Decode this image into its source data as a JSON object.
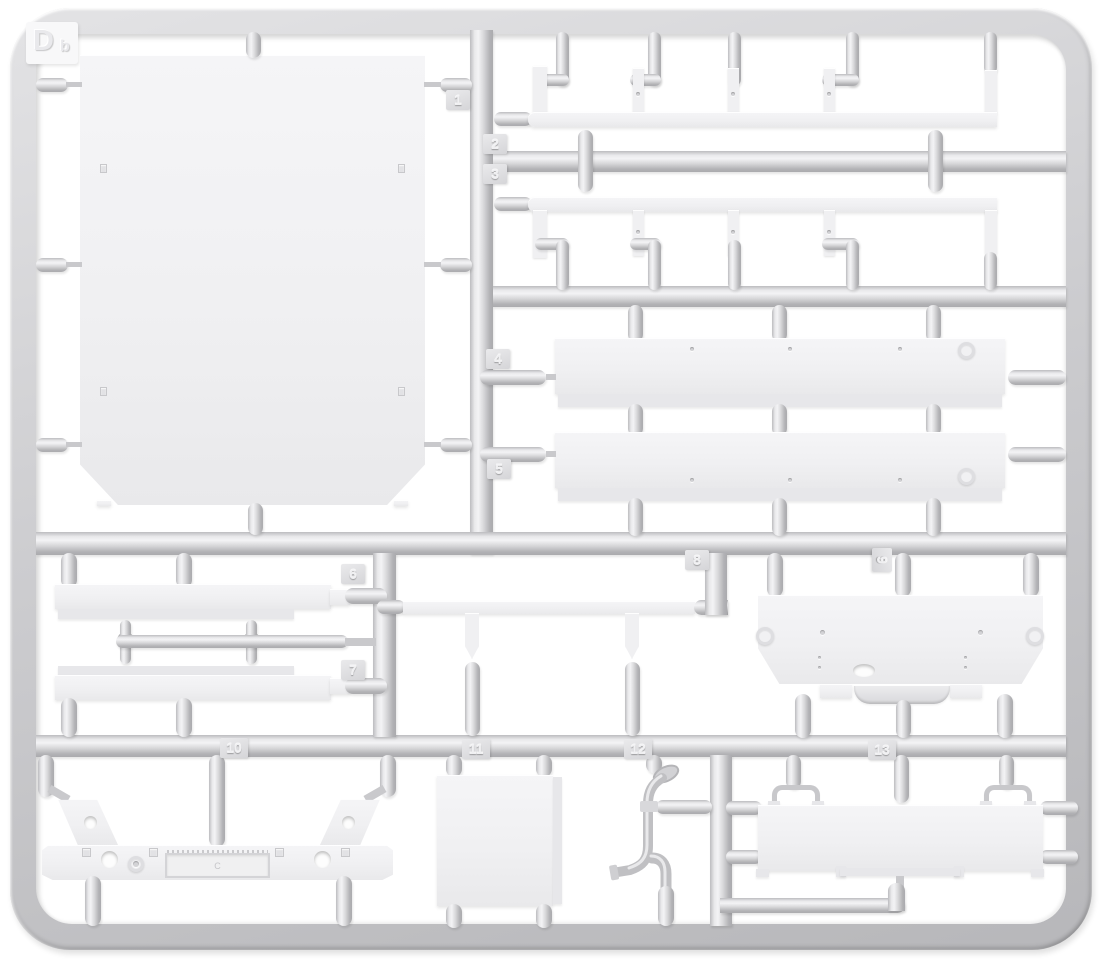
{
  "sprue": {
    "label": {
      "main": "D",
      "sub": "b"
    },
    "part_tags": [
      {
        "number": "1"
      },
      {
        "number": "2"
      },
      {
        "number": "3"
      },
      {
        "number": "4"
      },
      {
        "number": "5"
      },
      {
        "number": "6"
      },
      {
        "number": "7"
      },
      {
        "number": "8"
      },
      {
        "number": "9"
      },
      {
        "number": "10"
      },
      {
        "number": "11"
      },
      {
        "number": "12"
      },
      {
        "number": "13"
      }
    ],
    "bumper_plate_marking": "C",
    "material_colors": {
      "background": "#ffffff",
      "runner_mid": "#cdcdd0",
      "runner_highlight": "#f3f3f5",
      "runner_shadow": "#ababae",
      "part_face": "#f1f1f3",
      "tag_face": "#dedee1"
    }
  }
}
